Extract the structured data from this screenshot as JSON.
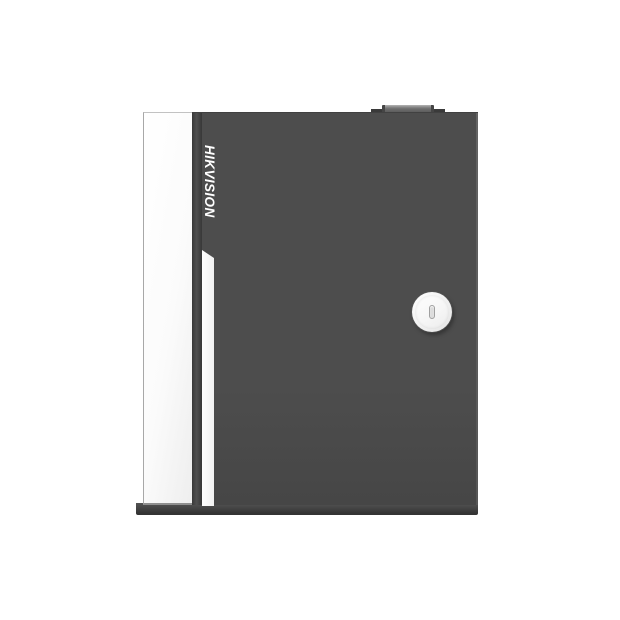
{
  "scene": {
    "description": "Product photo of a dark gray Hikvision access-control cabinet with white side panel, vertical brand logo, white accent stripe, round cam lock keyhole and small top hinge knob",
    "background_color": "#ffffff"
  },
  "device": {
    "brand": "HIKVISION",
    "lock_type": "round cam lock with vertical keyhole slot"
  },
  "colors": {
    "background": "#ffffff",
    "door-face": "#4d4d4d",
    "door-face-dark": "#464646",
    "door-edge-highlight": "#646464",
    "side-panel": "#fbfbfb",
    "side-panel-border": "#a8a8a8",
    "fold-dark": "#383838",
    "fold-mid": "#4f4f4f",
    "accent-stripe": "#ffffff",
    "base-dark": "#343434",
    "base-light": "#545454",
    "knob-body": "#6e6e6e",
    "knob-cap": "#b5b5b5",
    "knob-edge": "#454545",
    "flange": "#3a3a3a",
    "lock-face": "#f6f6f6",
    "lock-rim": "#777777",
    "slot-fill": "#dcdcdc",
    "slot-border": "#a0a0a0",
    "logo-color": "#ffffff"
  }
}
